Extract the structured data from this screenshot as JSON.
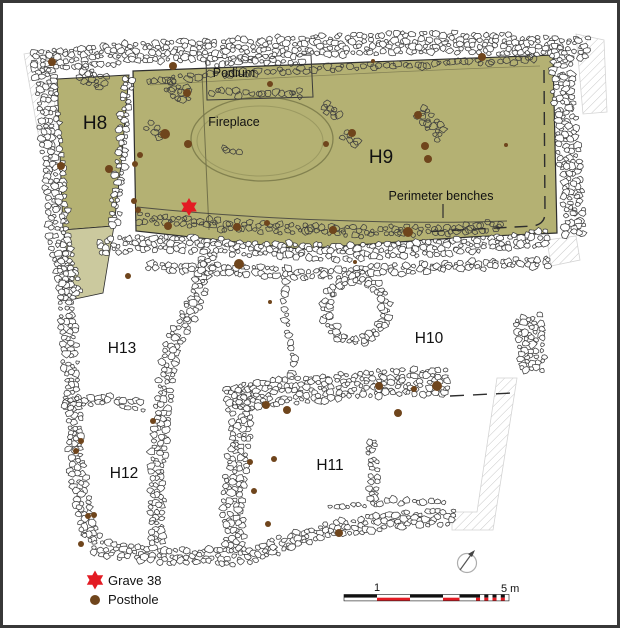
{
  "labels": {
    "h8": "H8",
    "h9": "H9",
    "h10": "H10",
    "h11": "H11",
    "h12": "H12",
    "h13": "H13",
    "podium": "Podium",
    "fireplace": "Fireplace",
    "perimeter_benches": "Perimeter benches"
  },
  "legend": {
    "items": [
      {
        "icon": "grave-star",
        "label": "Grave 38"
      },
      {
        "icon": "posthole-dot",
        "label": "Posthole"
      }
    ]
  },
  "scalebar": {
    "tick_1": "1",
    "tick_5": "5 m"
  },
  "colors": {
    "floor": "#b4b173",
    "floor_light": "#cbc99e",
    "posthole": "#6f451c",
    "grave_red": "#e31b23",
    "scale_red": "#e31b23",
    "stone_stroke": "#3f3f3f"
  },
  "features": {
    "grave": {
      "x": 189,
      "y": 207,
      "r": 9
    },
    "postholes": [
      [
        52,
        62,
        4
      ],
      [
        173,
        66,
        4
      ],
      [
        187,
        93,
        4
      ],
      [
        270,
        84,
        3
      ],
      [
        165,
        134,
        5
      ],
      [
        188,
        144,
        4
      ],
      [
        61,
        166,
        4
      ],
      [
        109,
        169,
        4
      ],
      [
        140,
        155,
        3
      ],
      [
        135,
        164,
        3
      ],
      [
        134,
        201,
        3
      ],
      [
        138,
        210,
        3
      ],
      [
        168,
        226,
        4
      ],
      [
        237,
        227,
        4
      ],
      [
        267,
        223,
        3
      ],
      [
        239,
        264,
        5
      ],
      [
        373,
        61,
        2
      ],
      [
        482,
        57,
        4
      ],
      [
        418,
        115,
        4
      ],
      [
        352,
        133,
        4
      ],
      [
        326,
        144,
        3
      ],
      [
        425,
        146,
        4
      ],
      [
        506,
        145,
        2
      ],
      [
        428,
        159,
        4
      ],
      [
        408,
        232,
        5
      ],
      [
        333,
        230,
        4
      ],
      [
        355,
        262,
        2
      ],
      [
        128,
        276,
        3
      ],
      [
        270,
        302,
        2
      ],
      [
        153,
        421,
        3
      ],
      [
        81,
        441,
        3
      ],
      [
        76,
        451,
        3
      ],
      [
        266,
        405,
        4
      ],
      [
        287,
        410,
        4
      ],
      [
        250,
        462,
        3
      ],
      [
        274,
        459,
        3
      ],
      [
        254,
        491,
        3
      ],
      [
        88,
        516,
        3
      ],
      [
        94,
        515,
        3
      ],
      [
        81,
        544,
        3
      ],
      [
        268,
        524,
        3
      ],
      [
        379,
        386,
        4
      ],
      [
        414,
        389,
        3
      ],
      [
        437,
        386,
        5
      ],
      [
        398,
        413,
        4
      ],
      [
        339,
        533,
        4
      ]
    ]
  }
}
